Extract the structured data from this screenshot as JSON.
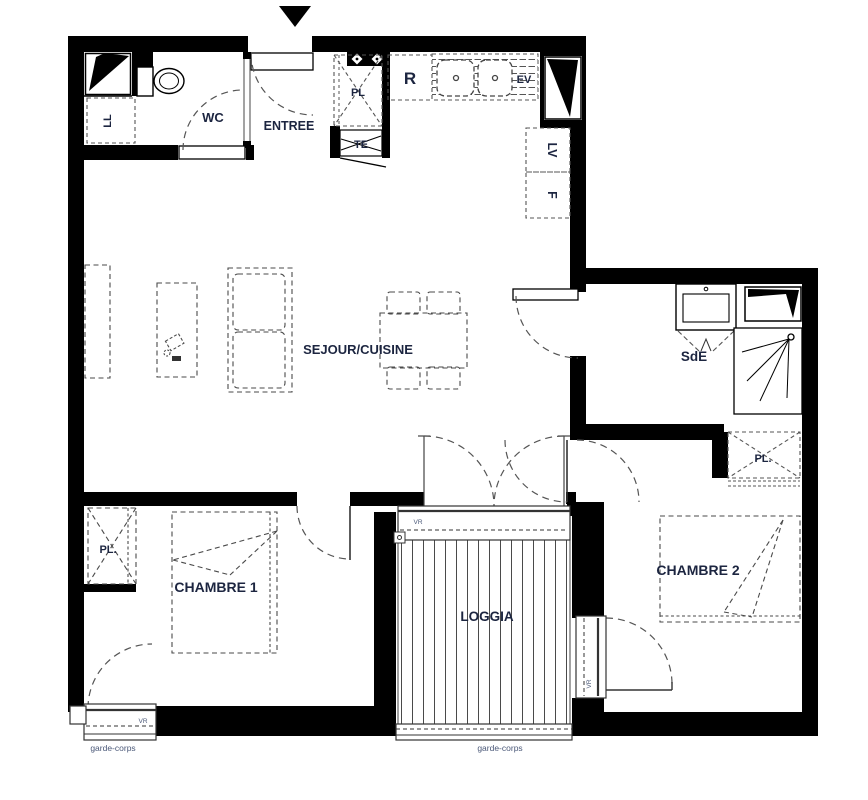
{
  "plan": {
    "rooms": {
      "wc": "WC",
      "entree": "ENTREE",
      "sejour_cuisine": "SEJOUR/CUISINE",
      "sde": "SdE",
      "chambre1": "CHAMBRE 1",
      "chambre2": "CHAMBRE 2",
      "loggia": "LOGGIA"
    },
    "equipment": {
      "pl_entree": "PL",
      "te": "TE",
      "ll": "LL",
      "r": "R",
      "ev": "EV",
      "lv": "LV",
      "f": "F",
      "pl_chambre1": "PL.",
      "pl_chambre2": "PL."
    },
    "windows": {
      "vr_chambre1": "VR",
      "vr_loggia": "VR",
      "vr_chambre2": "VR",
      "garde_corps_left": "garde-corps",
      "garde_corps_loggia": "garde-corps"
    },
    "colors": {
      "wall": "#000000",
      "room_label": "#1c2540",
      "small_label": "#4a5878",
      "furniture_line": "#4a4a4a"
    }
  }
}
